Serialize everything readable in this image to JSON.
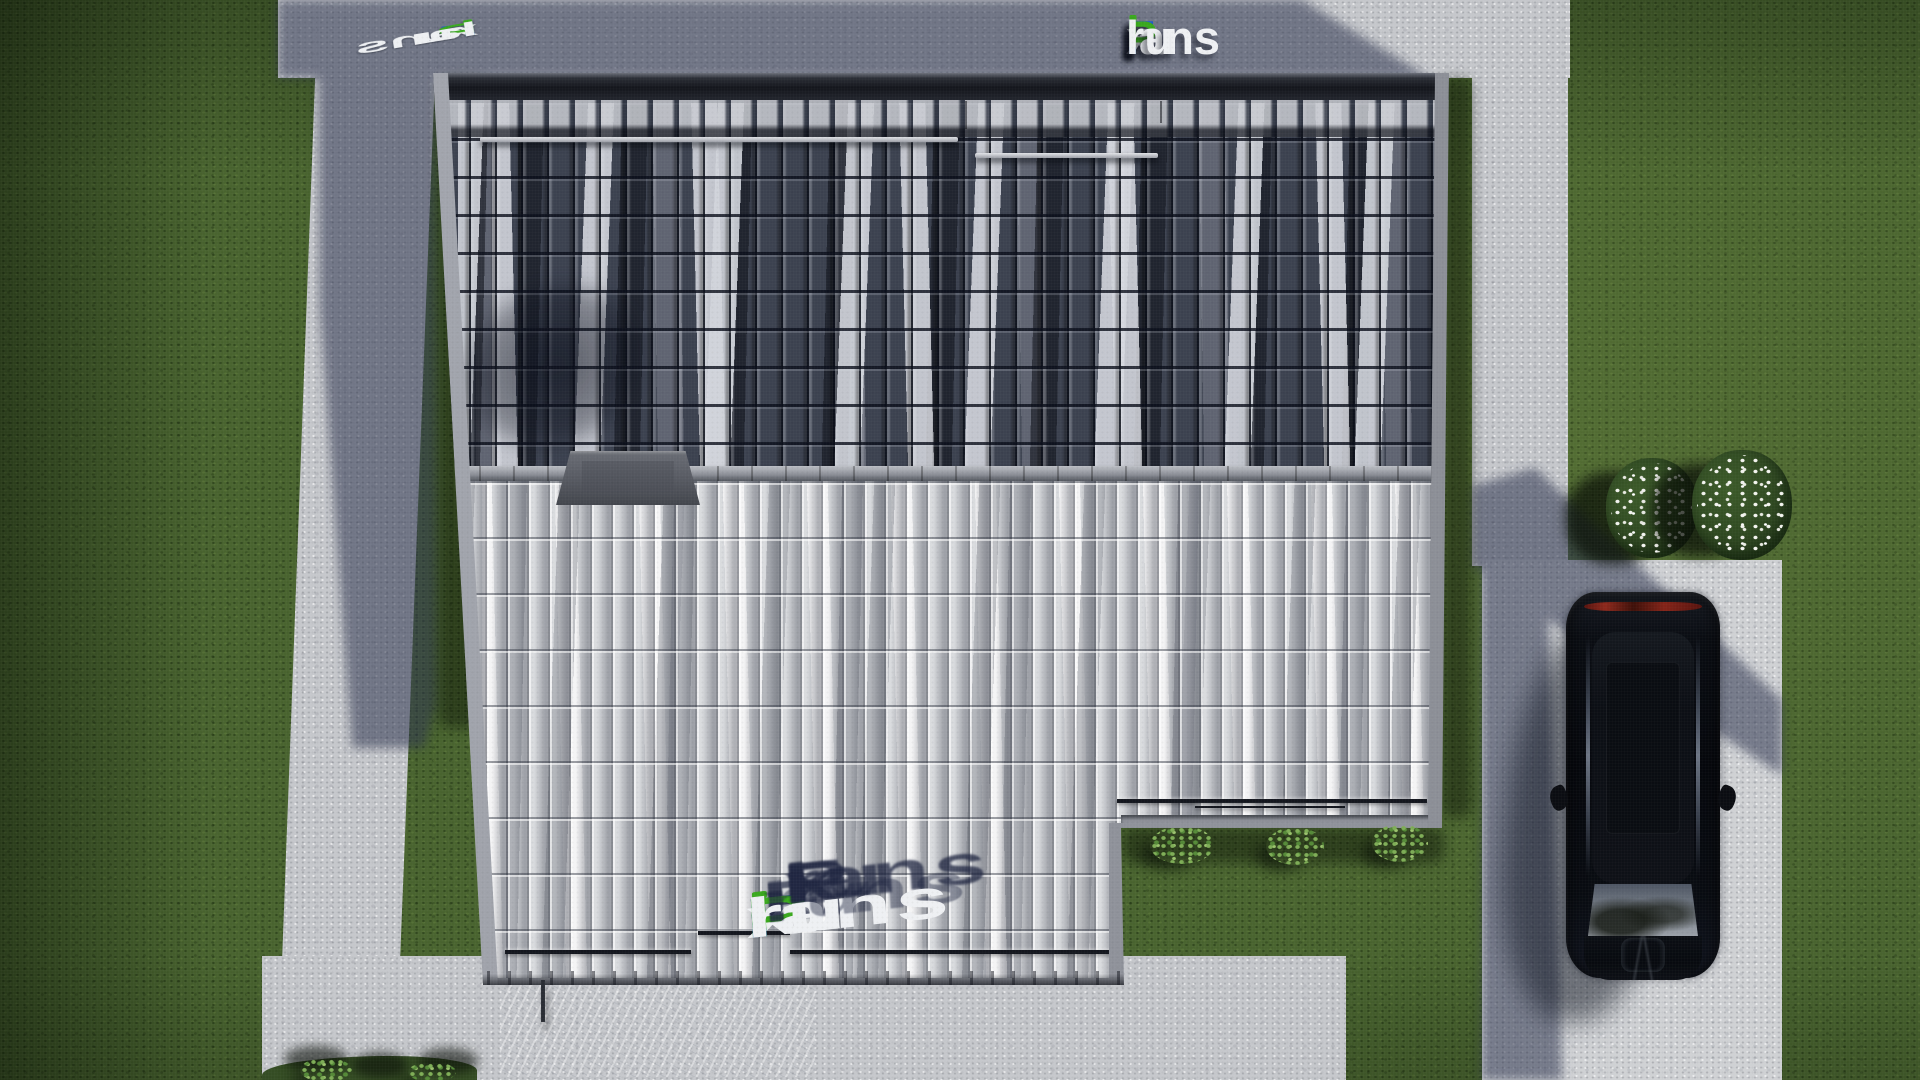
{
  "watermark": {
    "brand": "FixPlans.ru",
    "segments": [
      {
        "text": "F",
        "color": "#1e5fc9"
      },
      {
        "text": "i",
        "color": "#eef0f3",
        "dot": "#3aa81e"
      },
      {
        "text": "x",
        "color": "#eef0f3"
      },
      {
        "text": "P",
        "color": "#3aa81e"
      },
      {
        "text": "lans",
        "color": "#eef0f3"
      },
      {
        "text": ".",
        "color": "#1e5fc9"
      },
      {
        "text": "ru",
        "color": "#eef0f3"
      }
    ],
    "palette": {
      "blue": "#1e5fc9",
      "green": "#3aa81e",
      "white": "#eef0f3"
    }
  },
  "scene": {
    "description": "Aerial top-down 3D render of a house roof with lawn, concrete walkways, patio, driveway and a parked black SUV",
    "palette": {
      "grass": "#49642f",
      "grass_shadow": "#2e4520",
      "concrete": "#c5c7cb",
      "concrete_shadow": "#4a5370",
      "roof_dark_tiles": "#3c4250",
      "roof_light_tiles": "#d9dbde",
      "fascia": "#8f929a",
      "ridge": "#9da0a8",
      "chimney_cap": "#5a5d65",
      "car_body": "#0a0c11",
      "car_taillight": "#8f2318",
      "flowers": "#f2f3ee",
      "shrubs": "#6f9e49"
    },
    "objects": [
      "house-roof",
      "dark-roof-slope",
      "light-roof-slope",
      "ridge",
      "chimney-cap",
      "snow-guards",
      "lawn",
      "walkway-left",
      "walkway-top",
      "walkway-right",
      "patio-bottom",
      "driveway-pad",
      "black-suv",
      "flower-bushes",
      "shrubs"
    ]
  }
}
